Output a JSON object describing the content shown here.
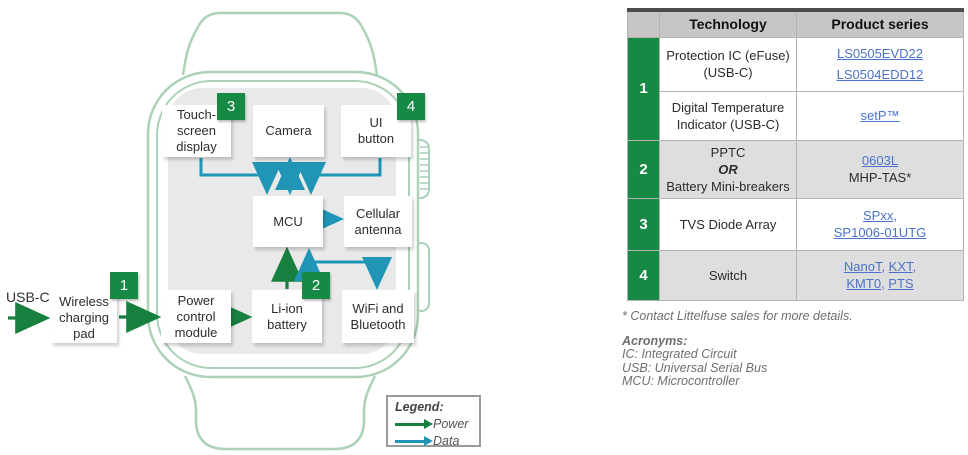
{
  "diagram": {
    "usb_label": "USB-C",
    "blocks": {
      "touch_screen_display": {
        "lines": [
          "Touch-",
          "screen",
          "display"
        ],
        "badge": "3"
      },
      "camera": {
        "lines": [
          "Camera"
        ]
      },
      "ui_button": {
        "lines": [
          "UI",
          "button"
        ],
        "badge": "4"
      },
      "mcu": {
        "lines": [
          "MCU"
        ]
      },
      "cellular_antenna": {
        "lines": [
          "Cellular",
          "antenna"
        ]
      },
      "power_control_module": {
        "lines": [
          "Power",
          "control",
          "module"
        ]
      },
      "li_ion_battery": {
        "lines": [
          "Li-ion",
          "battery"
        ],
        "badge": "2"
      },
      "wifi_bluetooth": {
        "lines": [
          "WiFi and",
          "Bluetooth"
        ]
      },
      "wireless_charging_pad": {
        "lines": [
          "Wireless",
          "charging",
          "pad"
        ],
        "badge": "1"
      }
    },
    "legend": {
      "title": "Legend:",
      "power_label": "Power",
      "data_label": "Data"
    }
  },
  "table": {
    "header": {
      "technology": "Technology",
      "product": "Product series"
    },
    "r1_num": "1",
    "r1a_tech1": "Protection IC (eFuse)",
    "r1a_tech2": "(USB-C)",
    "r1a_prod1": "LS0505EVD22",
    "r1a_prod2": "LS0504EDD12",
    "r1b_tech1": "Digital Temperature",
    "r1b_tech2": "Indicator (USB-C)",
    "r1b_prod1": "setP™",
    "r2_num": "2",
    "r2_tech1": "PPTC",
    "r2_tech2": "OR",
    "r2_tech3": "Battery Mini-breakers",
    "r2_prod1": "0603L",
    "r2_prod2": "MHP-TAS*",
    "r3_num": "3",
    "r3_tech": "TVS Diode Array",
    "r3_prod1": "SPxx",
    "r3_prod2": "SP1006-01UTG",
    "r4_num": "4",
    "r4_tech": "Switch",
    "r4_prod1": "NanoT",
    "r4_prod2": "KXT",
    "r4_prod3": "KMT0",
    "r4_prod4": "PTS",
    "comma": ",",
    "comma_space": ", "
  },
  "footnotes": {
    "contact": "* Contact Littelfuse sales for more details.",
    "acronyms_title": "Acronyms:",
    "acronyms": [
      "IC: Integrated Circuit",
      "USB: Universal Serial Bus",
      "MCU: Microcontroller"
    ]
  },
  "colors": {
    "brand_green": "#168a44",
    "power_arrow_green": "#17803f",
    "data_arrow_blue": "#2095b5",
    "link_blue": "#4a72cc",
    "watch_outline_green": "#abd2b6",
    "screen_gray": "#e9e9e9",
    "header_gray": "#c6c6c6",
    "row_gray": "#dedede"
  }
}
